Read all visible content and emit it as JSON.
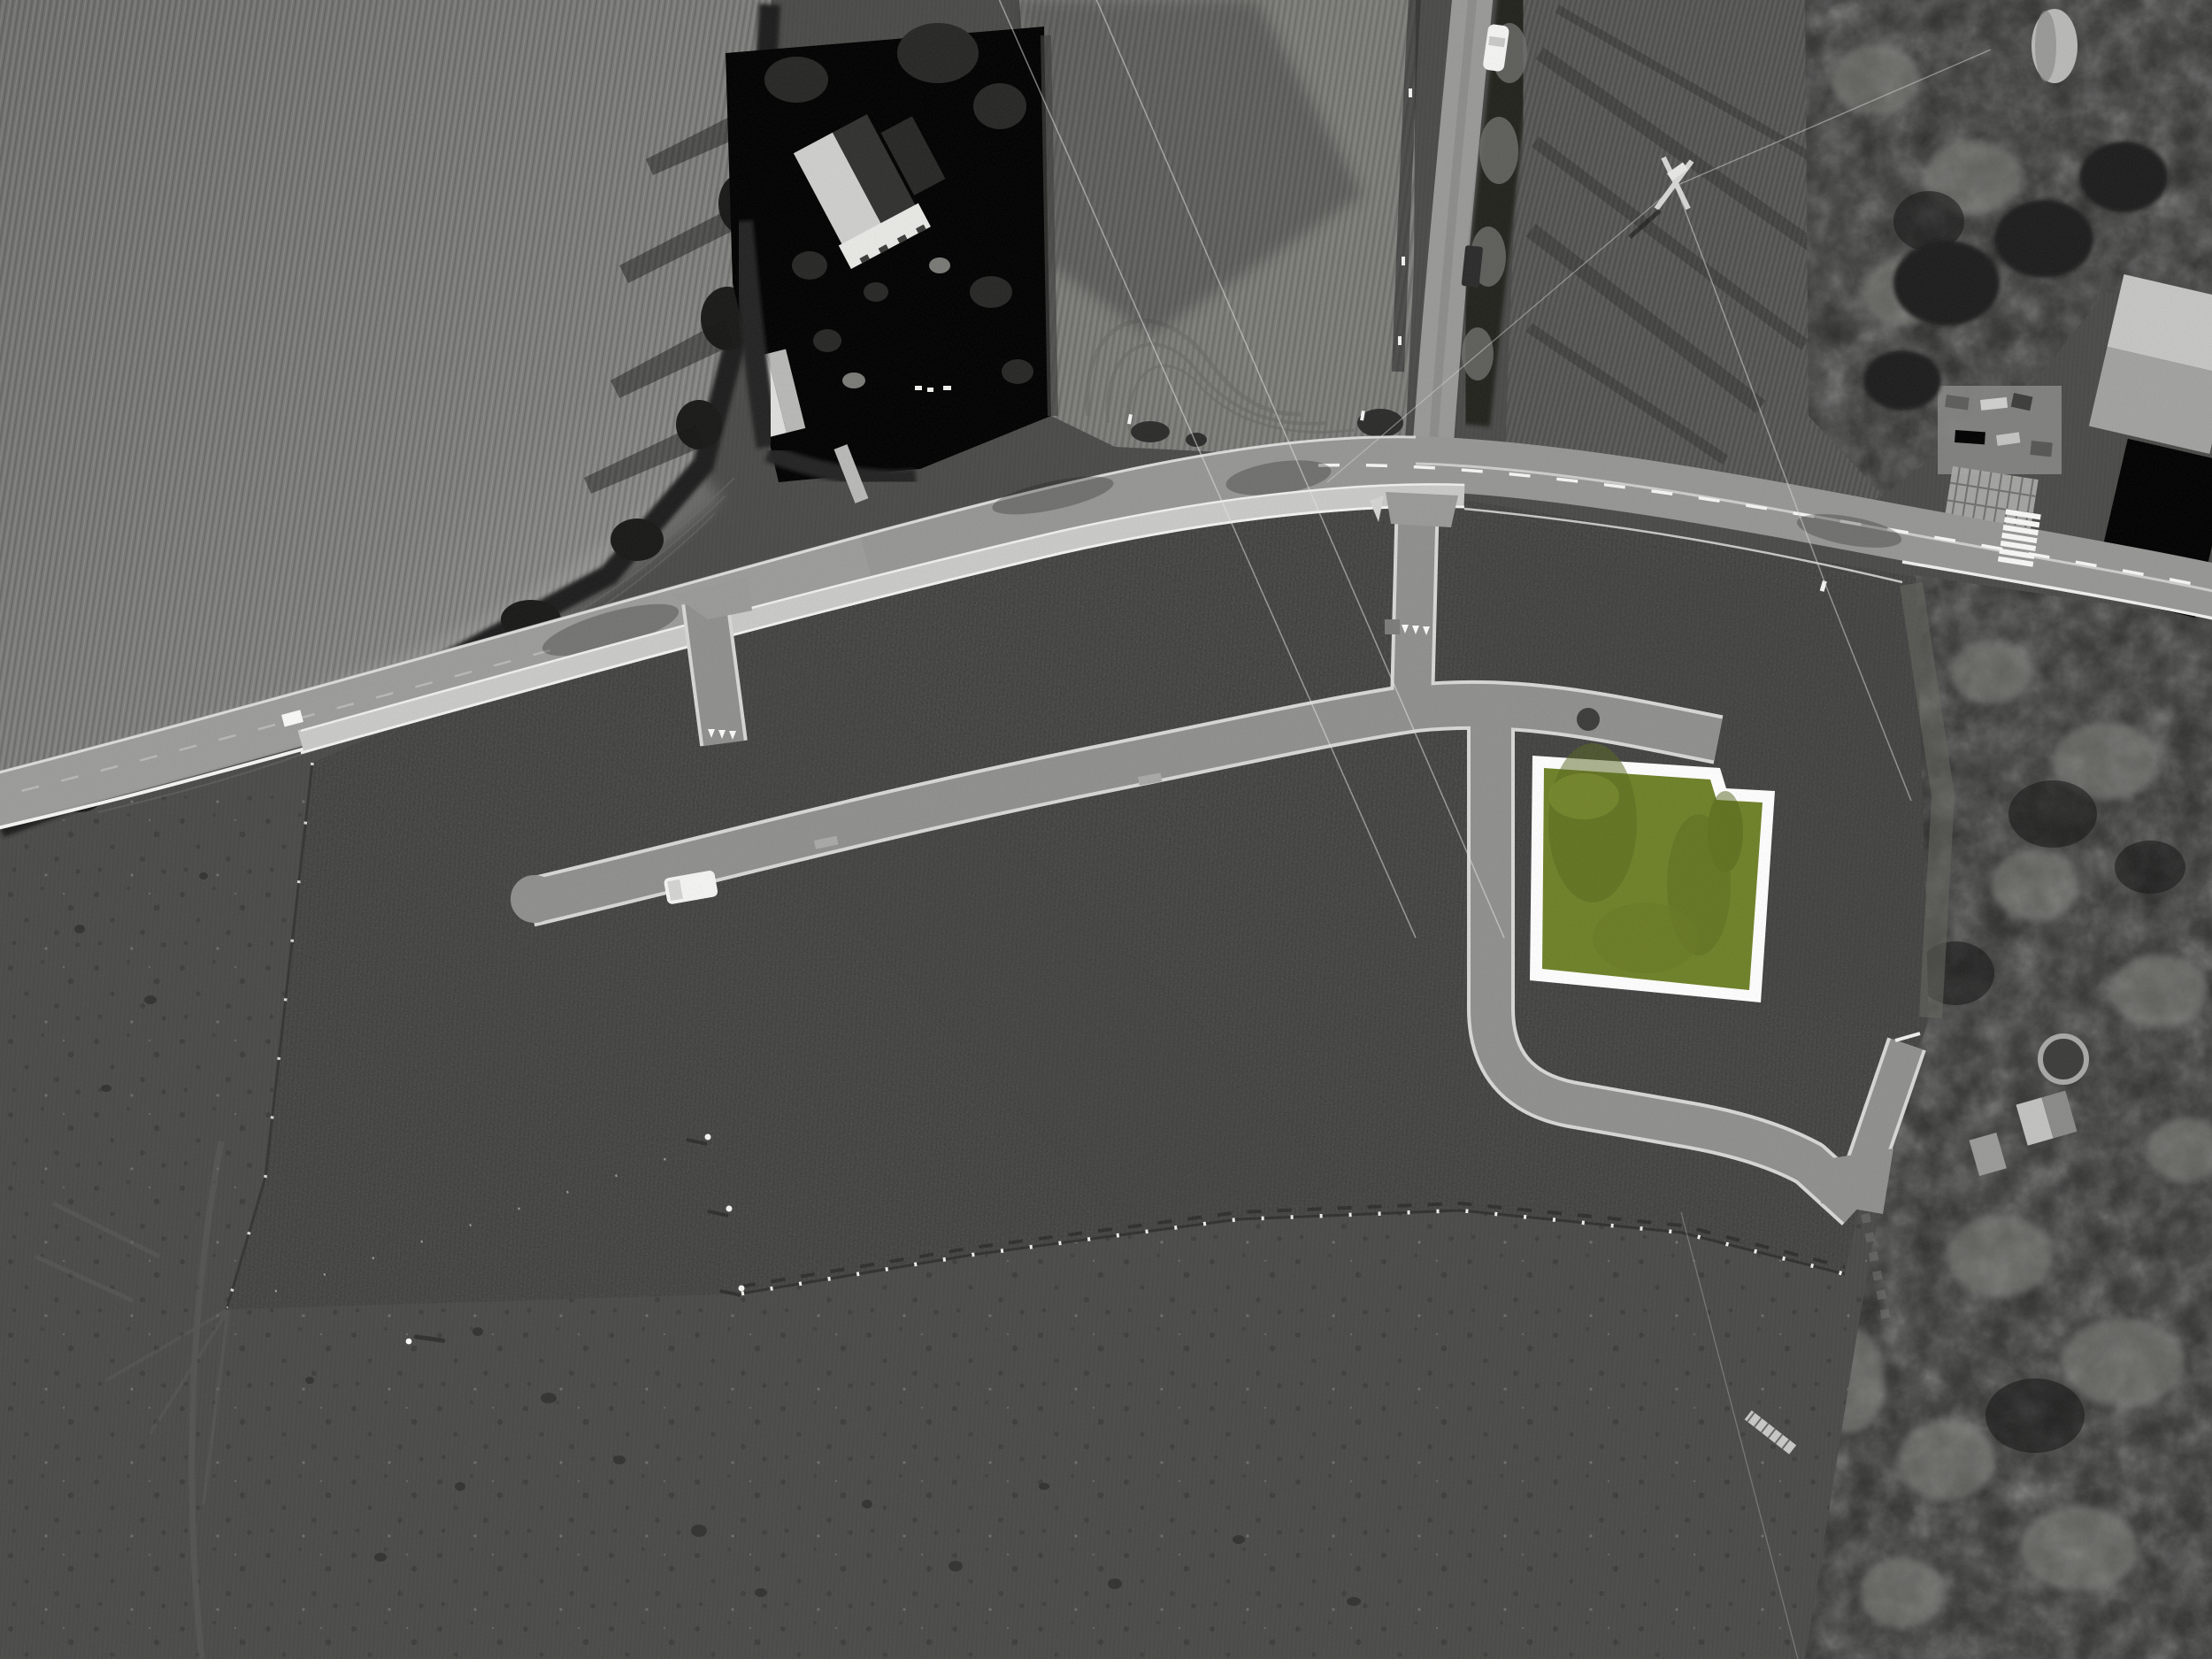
{
  "scene": {
    "title": "Grayscale aerial orthophoto of a new housing development site with one building plot highlighted",
    "style": "black-and-white aerial photo, single parcel tinted green with white boundary",
    "highlighted_plot": {
      "fill": "#6E8127",
      "fill_dark": "#57681D",
      "border": "#FFFFFF",
      "border_width_px": 13,
      "shape": "square with rectangular notch cut from top-right corner",
      "interactable": true
    },
    "colors": {
      "plot_fill": "#6E8127",
      "plot_border": "#FFFFFF",
      "main_road": "#969694",
      "estate_road": "#8F8F8D",
      "road_gutter": "#D8D8D6",
      "sidewalk": "#CACAC8",
      "marking_white": "#F7F7F5",
      "dev_field_dark": "#3B3B3A",
      "bottom_field": "#4B4B49",
      "plowed_field": "#7B7B79",
      "harrowed_field": "#7A7A76",
      "ne_field": "#565654",
      "woodland": "#2C2C2B",
      "hedge": "#1F1F1E",
      "vehicle_white": "#F5F5F3",
      "vehicle_dark": "#2A2A2A"
    },
    "road_markings": {
      "crosswalk_stripes": 7,
      "give_way_triangles_west_entrance": 3,
      "give_way_triangles_east_entrance": 3,
      "centre_line": "dashed white, eastern section",
      "edge_lines": "solid white along carriageway edges"
    },
    "vehicles": {
      "white_car_on_lane": 1,
      "dark_trailer_on_lane": 1,
      "white_van_on_estate_road": 1
    },
    "landmarks": {
      "farmhouse_with_gabled_roof": "top centre",
      "farmstead_buildings": "top right corner",
      "power_pylon": "upper right field",
      "garden_pool": "right woodland",
      "boundary_marker_ticks": "southern edge of development field"
    }
  }
}
